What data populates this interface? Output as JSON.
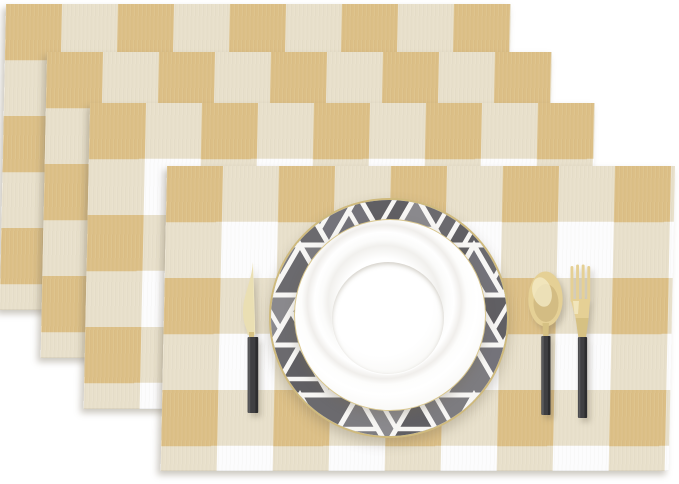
{
  "scene": {
    "type": "product-photo",
    "subject": "Set of 4 buffalo check placemats shown fanned in a stack with a place setting on top",
    "placemat_count": 4
  },
  "placemat": {
    "pattern": "buffalo-check",
    "check_size_px": 56,
    "colors": {
      "tan": "#dcbf86",
      "oatmeal": "#e8e0cb",
      "white": "#fcfcfd"
    }
  },
  "charger": {
    "style": "gray marble triangle mosaic rim",
    "rim_color": "#cfba7d",
    "base_color": "#fbfaf8",
    "triangle_palette": [
      "#6b6a6e",
      "#7d7c80",
      "#605f63",
      "#8a898d",
      "#74737a"
    ],
    "stripe_color": "#f7f6f4",
    "triangle_width_px": 58,
    "triangle_height_px": 50
  },
  "plate": {
    "color": "#ffffff",
    "rim_color": "#d8c68e"
  },
  "cutlery": {
    "pieces": [
      "knife",
      "spoon",
      "fork"
    ],
    "metal_color": "#e5d095",
    "metal_highlight": "#f4ecc8",
    "handle_color": "#3f3f42"
  },
  "background_color": "#ffffff"
}
